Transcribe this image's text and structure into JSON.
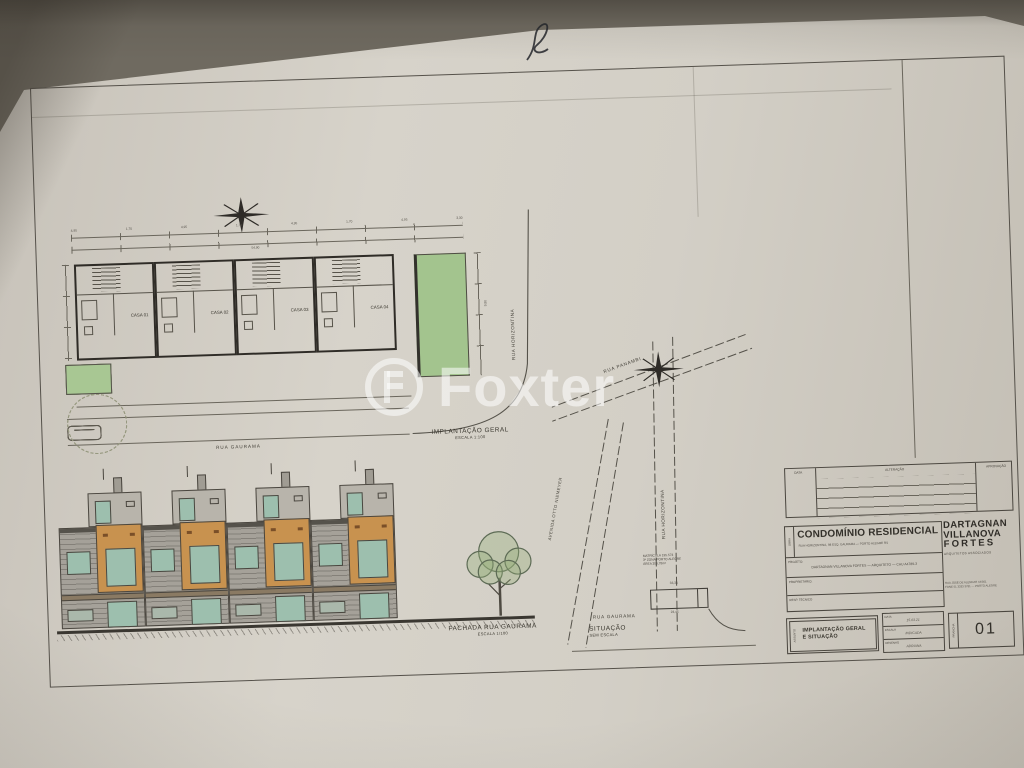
{
  "watermark": {
    "text": "Foxter"
  },
  "implantacao": {
    "title": "IMPLANTAÇÃO GERAL",
    "scale": "ESCALA 1:100",
    "houses": [
      "CASA 01",
      "CASA 02",
      "CASA 03",
      "CASA 04"
    ],
    "street_bottom": "RUA GAURAMA",
    "street_right": "RUA HORIZONTINA",
    "dims_top": [
      "4,95",
      "1,70",
      "4,95",
      "1,70",
      "4,95",
      "1,70",
      "4,95",
      "3,30"
    ],
    "dim_total": "54,90",
    "dim_right": "9,80"
  },
  "fachada": {
    "title": "FACHADA RUA GAURAMA",
    "scale": "ESCALA 1/100"
  },
  "situacao": {
    "title": "SITUAÇÃO",
    "scale": "SEM ESCALA",
    "street_top": "RUA PANAMBI",
    "street_left": "AVENIDA OTTO NIEMEYER",
    "street_right": "RUA HORIZONTINA",
    "street_bottom": "RUA GAURAMA",
    "lot_note": [
      "MATRÍCULA 195.573",
      "3ª ZONA PORTO ALEGRE",
      "ÁREA 356,78m²"
    ],
    "dim_top": "33,34",
    "dim_bottom": "23,45"
  },
  "titleblock": {
    "revision": {
      "headers": [
        "DATA",
        "ALTERAÇÃO",
        "APROVAÇÃO"
      ]
    },
    "obra_label": "OBRA",
    "title": "CONDOMÍNIO RESIDENCIAL",
    "subtitle": "RUA HORIZONTINA, 98 ESQ. GAURAMA — PORTO ALEGRE RS",
    "projeto_label": "PROJETO:",
    "projeto_value": "DARTAGNAN VILLANOVA FORTES — ARQUITETO — CAU A4789-3",
    "proprietario_label": "PROPRIETÁRIO:",
    "resp_label": "RESP. TÉCNICO",
    "assunto_label": "ASSUNTO",
    "assunto_line1": "IMPLANTAÇÃO GERAL",
    "assunto_line2": "E SITUAÇÃO",
    "info_rows": [
      {
        "label": "DATA",
        "value": "15.03.21"
      },
      {
        "label": "ESCALA",
        "value": "INDICADA"
      },
      {
        "label": "DESENHO",
        "value": "ADRIANA"
      }
    ],
    "firm": {
      "line1": "DARTAGNAN",
      "line2": "VILLANOVA",
      "line3": "FORTES",
      "tagline": "ARQUITETOS ASSOCIADOS",
      "addr1": "RUA JOSÉ DE ALENCAR 44/301",
      "addr2": "FONE 51 3333 3781 — PORTO ALEGRE"
    },
    "prancha_label": "PRANCHA",
    "prancha_number": "01"
  },
  "colors": {
    "green": "#a3c48e",
    "orange": "#c8924f",
    "teal": "#9dbfae",
    "paper": "#d3cfc6",
    "ink": "#3a372f"
  }
}
